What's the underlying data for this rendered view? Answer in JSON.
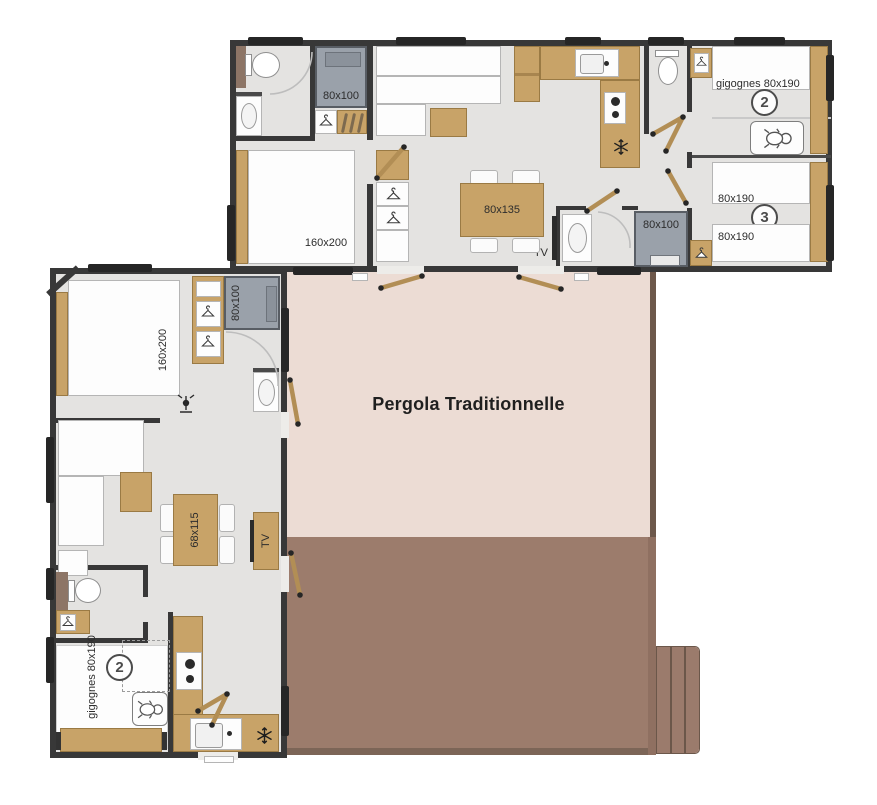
{
  "pergola": {
    "label": "Pergola Traditionnelle"
  },
  "upper_unit": {
    "master_bed": "160x200",
    "shower_left": "80x100",
    "shower_right": "80x100",
    "dining_table": "80x135",
    "tv": "TV",
    "bedroom2": {
      "number": "2",
      "beds": "gigognes 80x190"
    },
    "bedroom3": {
      "number": "3",
      "bed_top": "80x190",
      "bed_bottom": "80x190"
    }
  },
  "lower_unit": {
    "master_bed": "160x200",
    "shower": "80x100",
    "dining_table": "68x115",
    "tv": "TV",
    "bedroom2": {
      "number": "2",
      "beds": "gigognes 80x190"
    }
  },
  "colors": {
    "wall": "#383838",
    "floor": "#e4e3e1",
    "wood": "#c8a368",
    "shower_grey": "#9aa1aa",
    "pergola_fill": "#ecdcd4",
    "deck_fill": "#9c7c6c",
    "deck_edge": "#6d584b"
  }
}
